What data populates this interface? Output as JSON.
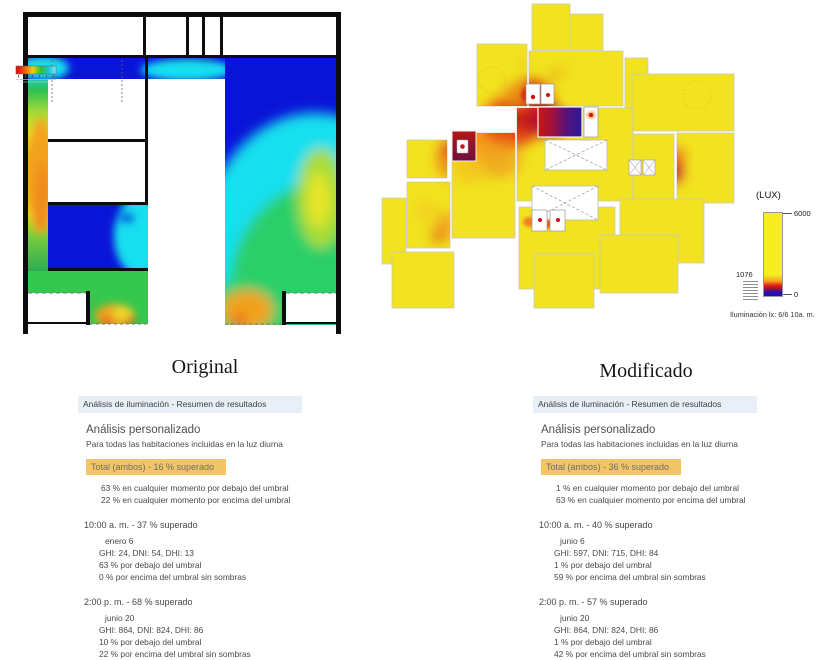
{
  "colors": {
    "highlight": "#f2c666",
    "header_bg": "#e9eff7",
    "heat_blue": "#0a14d8",
    "heat_cyan": "#17dfee",
    "heat_green": "#2bcf6b",
    "heat_yellow": "#f1e31f",
    "heat_orange": "#f2a21f",
    "heat_red": "#e63517",
    "heat_dark_purple": "#3a1a8c"
  },
  "legend": {
    "unit": "(LUX)",
    "max": "6000",
    "threshold": "1076",
    "min": "0",
    "caption": "Iluminación lx: 6/6 10a. m."
  },
  "panels": [
    {
      "title": "Original",
      "header": "Análisis de iluminación - Resumen de resultados",
      "subtitle": "Análisis personalizado",
      "description": "Para todas las habitaciones incluidas en la luz diurna",
      "total": "Total (ambos)  - 16 % superado",
      "below_threshold": "63 % en cualquier momento por debajo del umbral",
      "above_threshold": "22 % en cualquier momento por encima del umbral",
      "sections": [
        {
          "time": "10:00 a. m.  - 37 % superado",
          "date": "enero 6",
          "irradiance": "GHI: 24, DNI: 54, DHI: 13",
          "below": "63 % por debajo del umbral",
          "above": "0 % por encima del umbral sin sombras"
        },
        {
          "time": "2:00 p. m.  - 68 % superado",
          "date": "junio 20",
          "irradiance": "GHI: 864, DNI: 824, DHI: 86",
          "below": "10 % por debajo del umbral",
          "above": "22 % por encima del umbral sin sombras"
        }
      ]
    },
    {
      "title": "Modificado",
      "header": "Análisis de iluminación - Resumen de resultados",
      "subtitle": "Análisis personalizado",
      "description": "Para todas las habitaciones incluidas en la luz diurna",
      "total": "Total (ambos)  - 36 % superado",
      "below_threshold": "1 % en cualquier momento por debajo del umbral",
      "above_threshold": "63 % en cualquier momento por encima del umbral",
      "sections": [
        {
          "time": "10:00 a. m.  - 40 % superado",
          "date": "junio 6",
          "irradiance": "GHI: 597, DNI: 715, DHI: 84",
          "below": "1 % por debajo del umbral",
          "above": "59 % por encima del umbral sin sombras"
        },
        {
          "time": "2:00 p. m.  - 57 % superado",
          "date": "junio 20",
          "irradiance": "GHI: 864, DNI: 824, DHI: 86",
          "below": "1 % por debajo del umbral",
          "above": "42 % por encima del umbral sin sombras"
        }
      ]
    }
  ]
}
